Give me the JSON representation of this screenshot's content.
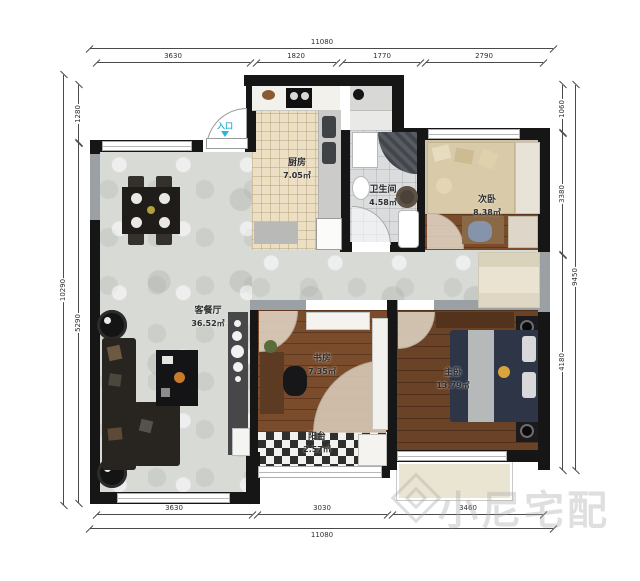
{
  "entrance": {
    "label": "入口"
  },
  "rooms": {
    "kitchen": {
      "name": "厨房",
      "area": "7.05㎡"
    },
    "bathroom": {
      "name": "卫生间",
      "area": "4.58㎡"
    },
    "bedroom2": {
      "name": "次卧",
      "area": "8.38㎡"
    },
    "living": {
      "name": "客餐厅",
      "area": "36.52㎡"
    },
    "study": {
      "name": "书房",
      "area": "7.35㎡"
    },
    "balcony": {
      "name": "阳台",
      "area": "2.57㎡"
    },
    "master": {
      "name": "主卧",
      "area": "13.79㎡"
    }
  },
  "dimensions": {
    "top": {
      "total": "11080",
      "segments": [
        "3630",
        "1820",
        "1770",
        "2790"
      ]
    },
    "bottom": {
      "total": "11080",
      "segments": [
        "3630",
        "3030",
        "3460"
      ]
    },
    "left": {
      "total": "10290",
      "segments": [
        "1280",
        "5290"
      ]
    },
    "right": {
      "total": "9450",
      "segments": [
        "1060",
        "3380",
        "4180"
      ]
    }
  },
  "watermark": {
    "brand": "小尼宅配"
  },
  "colors": {
    "wall": "#161616",
    "entrance_accent": "#2fb3d6",
    "wood": "#7a4c2b",
    "carpet": "#cec2a4"
  }
}
